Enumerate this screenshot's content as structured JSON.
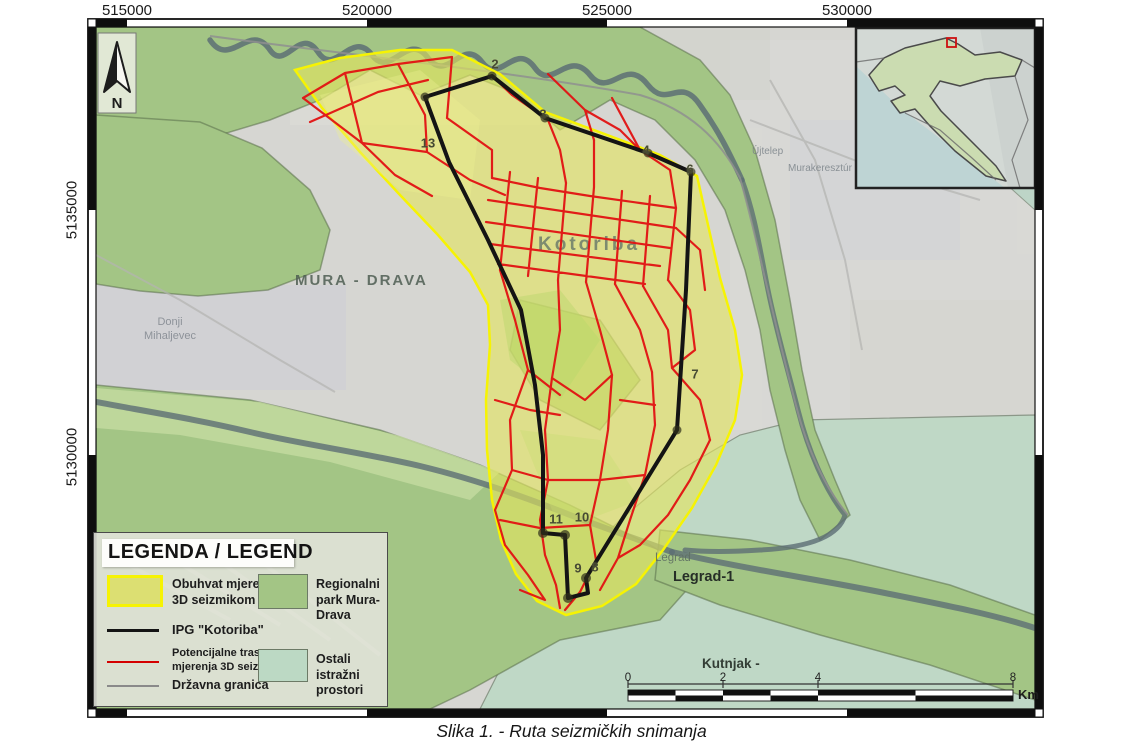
{
  "figure": {
    "caption": "Slika 1. - Ruta seizmičkih snimanja"
  },
  "map": {
    "x_ticks": [
      "515000",
      "520000",
      "525000",
      "530000"
    ],
    "y_ticks": [
      "5135000",
      "5130000"
    ],
    "north_label": "N",
    "places": {
      "mura_drava": "MURA - DRAVA",
      "kotoriba": "Kotoriba",
      "legrad": "Legrad",
      "legrad_1": "Legrad-1",
      "kutnjak": "Kutnjak -",
      "donji_mihaljevec": "Donji Mihaljevec",
      "ujtelep": "Újtelep",
      "murakeresztur": "Murakeresztúr"
    },
    "waypoints": [
      "2",
      "3",
      "4",
      "6",
      "13",
      "7",
      "11",
      "10",
      "9",
      "8"
    ],
    "scalebar": {
      "ticks": [
        "0",
        "2",
        "4",
        "8"
      ],
      "unit": "Km"
    }
  },
  "legend": {
    "title": "LEGENDA / LEGEND",
    "items": [
      {
        "label": "Obuhvat mjerenja 3D seizmikom",
        "type": "area",
        "fill": "#dcdf72",
        "border": "#f6f303"
      },
      {
        "label": "IPG \"Kotoriba\"",
        "type": "line",
        "color": "#141414"
      },
      {
        "label": "Potencijalne trase mjerenja 3D seizmike",
        "type": "line",
        "color": "#d40000"
      },
      {
        "label": "Državna granica",
        "type": "line",
        "color": "#8a8a8a"
      },
      {
        "label": "Regionalni park Mura-Drava",
        "type": "area",
        "fill": "#a3c585",
        "border": "#6c7a66"
      },
      {
        "label": "Ostali istražni prostori",
        "type": "area",
        "fill": "#bcd9c4",
        "border": "#6c7a66"
      }
    ]
  },
  "colors": {
    "survey_fill": "#e3e560",
    "survey_border": "#f6f303",
    "ipg_boundary": "#141414",
    "seismic_routes": "#e21212",
    "state_border": "#8f8f8f",
    "park_fill": "#a3c585",
    "other_blocks_fill": "#bcd9c4",
    "river": "#5d6e74",
    "inset_highlight": "#cc1111"
  }
}
